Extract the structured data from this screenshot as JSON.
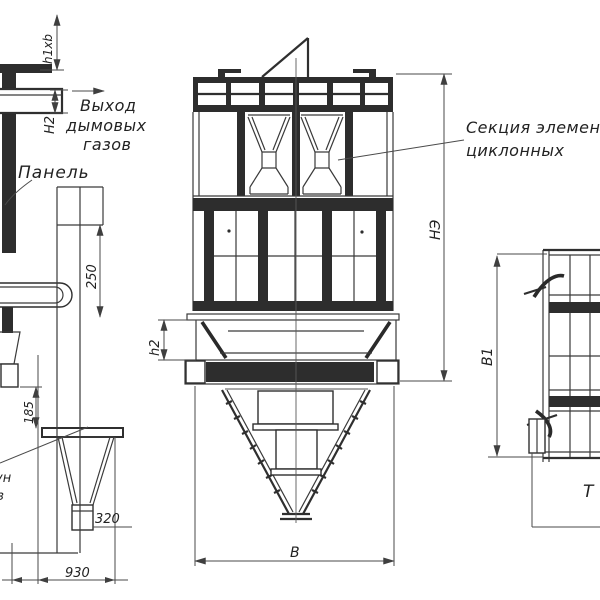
{
  "drawing_labels": {
    "gas_outlet": {
      "line1": "Выход",
      "line2": "дымовых",
      "line3": "газов"
    },
    "panel": "Панель",
    "cyclone_section": {
      "line1": "Секция элемен",
      "line2": "циклонных"
    },
    "clipped_left": {
      "line1": "ун",
      "line2": "з"
    }
  },
  "dims": {
    "h1xb": "h1xb",
    "H2": "Н2",
    "d250": "250",
    "d185": "185",
    "d320": "320",
    "d930": "930",
    "h2": "h2",
    "NE": "НЭ",
    "B": "В",
    "B1": "В1",
    "T": "Т"
  },
  "colors": {
    "line": "#333333",
    "dim_line": "#4a4a4a",
    "background": "#ffffff"
  }
}
